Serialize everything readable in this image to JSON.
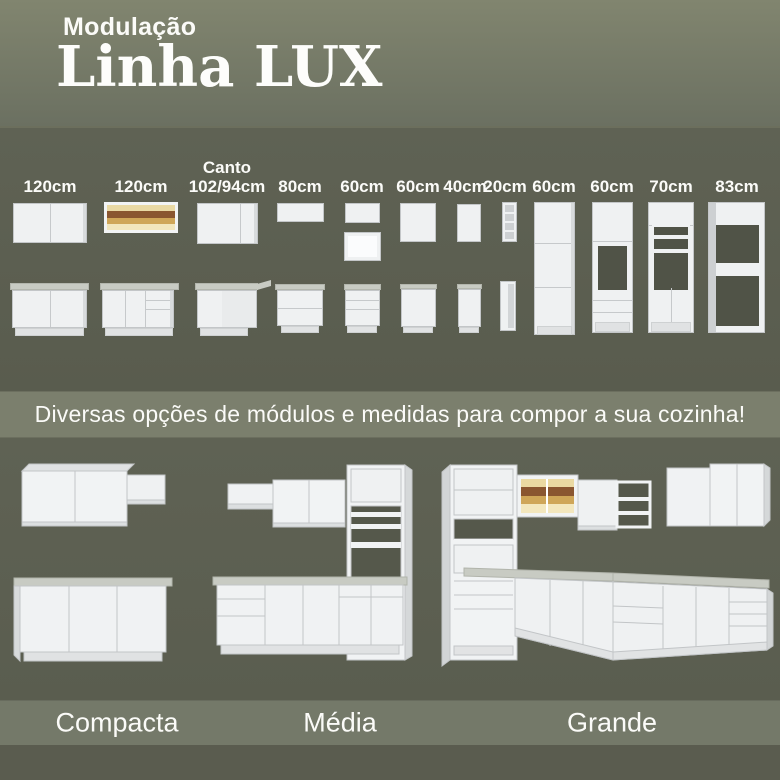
{
  "header": {
    "kicker": "Modulação",
    "title": "Linha LUX"
  },
  "modules": {
    "items": [
      {
        "label": "120cm",
        "icon": "wall-cabinet-2-door-icon / base-cabinet-2-door-icon"
      },
      {
        "label": "120cm",
        "icon": "glass-wall-cabinet-icon / base-cabinet-door-drawer-icon"
      },
      {
        "label_top": "Canto",
        "label": "102/94cm",
        "icon": "corner-wall-cabinet-icon / corner-base-cabinet-icon"
      },
      {
        "label": "80cm",
        "icon": "wall-cabinet-icon / drawer-base-cabinet-icon"
      },
      {
        "label": "60cm",
        "icon": "wall-cabinet-icon / open-niche-icon / drawer-base-cabinet-icon"
      },
      {
        "label": "60cm",
        "icon": "wall-cabinet-1-door-icon / base-cabinet-1-door-icon"
      },
      {
        "label": "40cm",
        "icon": "narrow-wall-cabinet-icon / narrow-base-cabinet-icon"
      },
      {
        "label": "20cm",
        "icon": "shelf-unit-icon / narrow-shelf-unit-icon"
      },
      {
        "label": "60cm",
        "icon": "pantry-tower-icon"
      },
      {
        "label": "60cm",
        "icon": "oven-tower-icon"
      },
      {
        "label": "70cm",
        "icon": "open-shelf-tower-icon"
      },
      {
        "label": "83cm",
        "icon": "fridge-frame-tower-icon"
      }
    ]
  },
  "tagline": {
    "text": "Diversas opções de módulos e medidas para compor a sua cozinha!"
  },
  "kitchens": {
    "items": [
      {
        "label": "Compacta",
        "icon": "kitchen-compacta-illustration"
      },
      {
        "label": "Média",
        "icon": "kitchen-media-illustration"
      },
      {
        "label": "Grande",
        "icon": "kitchen-grande-illustration"
      }
    ]
  },
  "colors": {
    "header_bg": "#7a7e6c",
    "section_dark": "#5d6053",
    "band_light": "#7b7f6d",
    "label_band": "#747969",
    "text": "#fbfbf8",
    "cabinet_white": "#eff1f2",
    "countertop": "#c8cbc3",
    "glass_amber": "#cfa658",
    "glass_brown": "#8a5630"
  }
}
